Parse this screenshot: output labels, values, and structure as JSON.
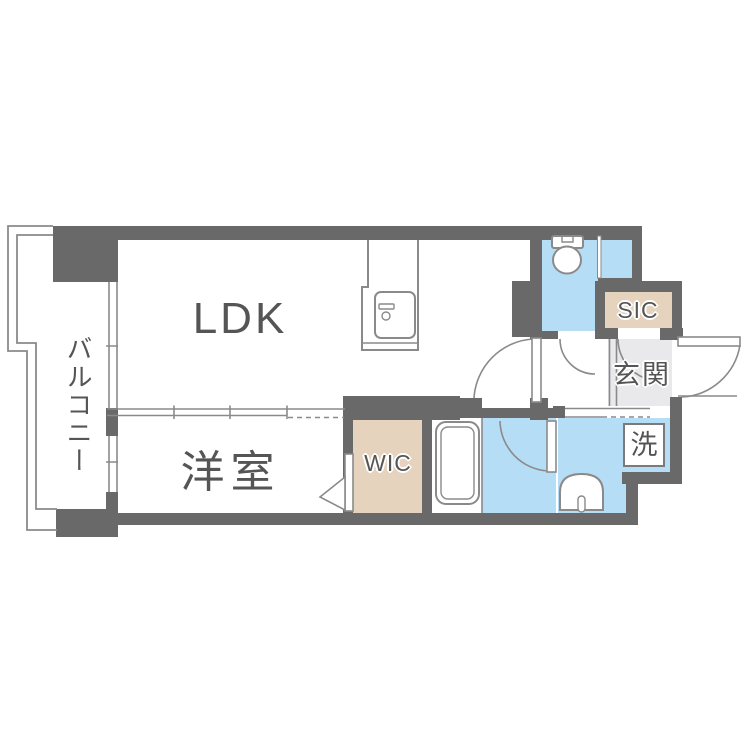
{
  "plan_title": "apartment-floor-plan",
  "rooms": {
    "ldk": {
      "label": "LDK"
    },
    "western_room": {
      "label": "洋室"
    },
    "balcony": {
      "label": "バルコニー"
    },
    "wic": {
      "label": "WIC"
    },
    "sic": {
      "label": "SIC"
    },
    "entrance": {
      "label": "玄関"
    },
    "laundry": {
      "label": "洗"
    }
  },
  "fixtures": [
    "toilet",
    "kitchen-sink",
    "bathtub",
    "washbasin",
    "washing-machine-space"
  ],
  "colors": {
    "wall": "#696969",
    "water_blue": "#b5ddf5",
    "closet_beige": "#e5d3bd",
    "entry_gray": "#e9e9eb",
    "thin_line": "#8a8a8a",
    "text": "#555555"
  }
}
